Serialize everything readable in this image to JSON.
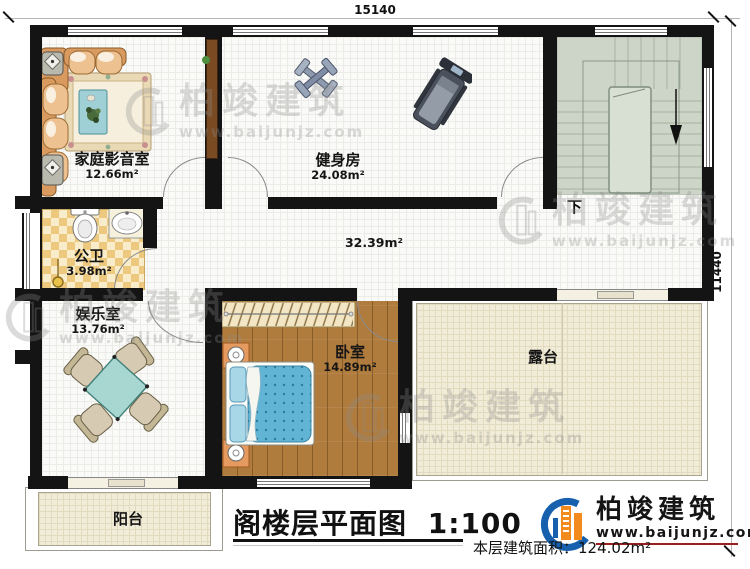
{
  "title": {
    "text": "阁楼层平面图",
    "scale": "1:100"
  },
  "footer": {
    "label": "本层建筑面积：",
    "value": "124.02m²"
  },
  "dimensions": {
    "top": "15140",
    "right": "11440"
  },
  "rooms": {
    "home_theater": {
      "name": "家庭影音室",
      "area": "12.66m²"
    },
    "gym": {
      "name": "健身房",
      "area": "24.08m²"
    },
    "bathroom": {
      "name": "公卫",
      "area": "3.98m²"
    },
    "entertainment": {
      "name": "娱乐室",
      "area": "13.76m²"
    },
    "bedroom": {
      "name": "卧室",
      "area": "14.89m²"
    },
    "hall": {
      "area": "32.39m²"
    },
    "terrace": {
      "name": "露台"
    },
    "balcony": {
      "name": "阳台"
    }
  },
  "stairs": {
    "down_label": "下"
  },
  "watermark": {
    "name": "柏竣建筑",
    "url": "www.baijunjz.com"
  },
  "logo": {
    "name": "柏竣建筑",
    "url": "www.baijunjz.com"
  },
  "colors": {
    "wall": "#141414",
    "stairs": "#cdd5c8",
    "wood": "#b07c3e",
    "outdoor": "#f1ecd8",
    "bath_tile": "#ecc97f",
    "bed_blue": "#62b4d4",
    "logo_blue": "#1660ad",
    "logo_orange": "#f28a1d"
  }
}
